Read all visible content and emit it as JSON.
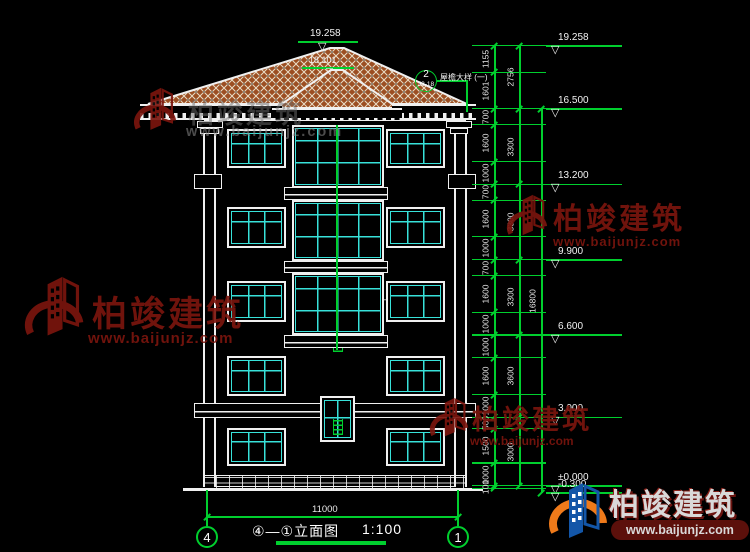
{
  "colors": {
    "line": "#f0f0f0",
    "green": "#00cf2e",
    "cyan": "#38e2da",
    "roof": "#9c4e22",
    "roofline": "#e9ddc6",
    "wmred": "#7a150e",
    "logo_blue": "#1356a8",
    "logo_orange": "#ef7a1a"
  },
  "building": {
    "peak_elevation": "19.258",
    "secondary_peak_elevation": "18.101",
    "callout_eave": {
      "number": "2",
      "sheet_ref": "J3-18",
      "label": "屋檐大样 (一)"
    },
    "callout_balcony": {
      "number": "1",
      "sheet_ref": "J3-18",
      "label": "阳台栏杆大样 (一)"
    }
  },
  "dimensions": {
    "right_inner_chain": [
      "1155",
      "1601",
      "700",
      "1600",
      "1000",
      "700",
      "1600",
      "1000",
      "700",
      "1600",
      "1000",
      "1000",
      "1600",
      "1000",
      "500",
      "1500",
      "1000",
      "100"
    ],
    "right_group_chain": [
      "2756",
      "3300",
      "3300",
      "3300",
      "3600",
      "3000"
    ],
    "right_total": "16800",
    "bottom_width": "11000"
  },
  "elevation_markers": [
    {
      "label": "19.258",
      "mm": 19258
    },
    {
      "label": "16.500",
      "mm": 16500
    },
    {
      "label": "13.200",
      "mm": 13200
    },
    {
      "label": "9.900",
      "mm": 9900
    },
    {
      "label": "6.600",
      "mm": 6600
    },
    {
      "label": "3.000",
      "mm": 3000
    },
    {
      "label": "±0.000",
      "mm": 0
    },
    {
      "label": "-0.300",
      "mm": -300
    }
  ],
  "axis_bubbles": [
    {
      "id": "4"
    },
    {
      "id": "1"
    }
  ],
  "title": {
    "name": "④—①立面图",
    "scale": "1:100"
  },
  "watermark": {
    "brand": "柏竣建筑",
    "url": "www.baijunjz.com"
  }
}
